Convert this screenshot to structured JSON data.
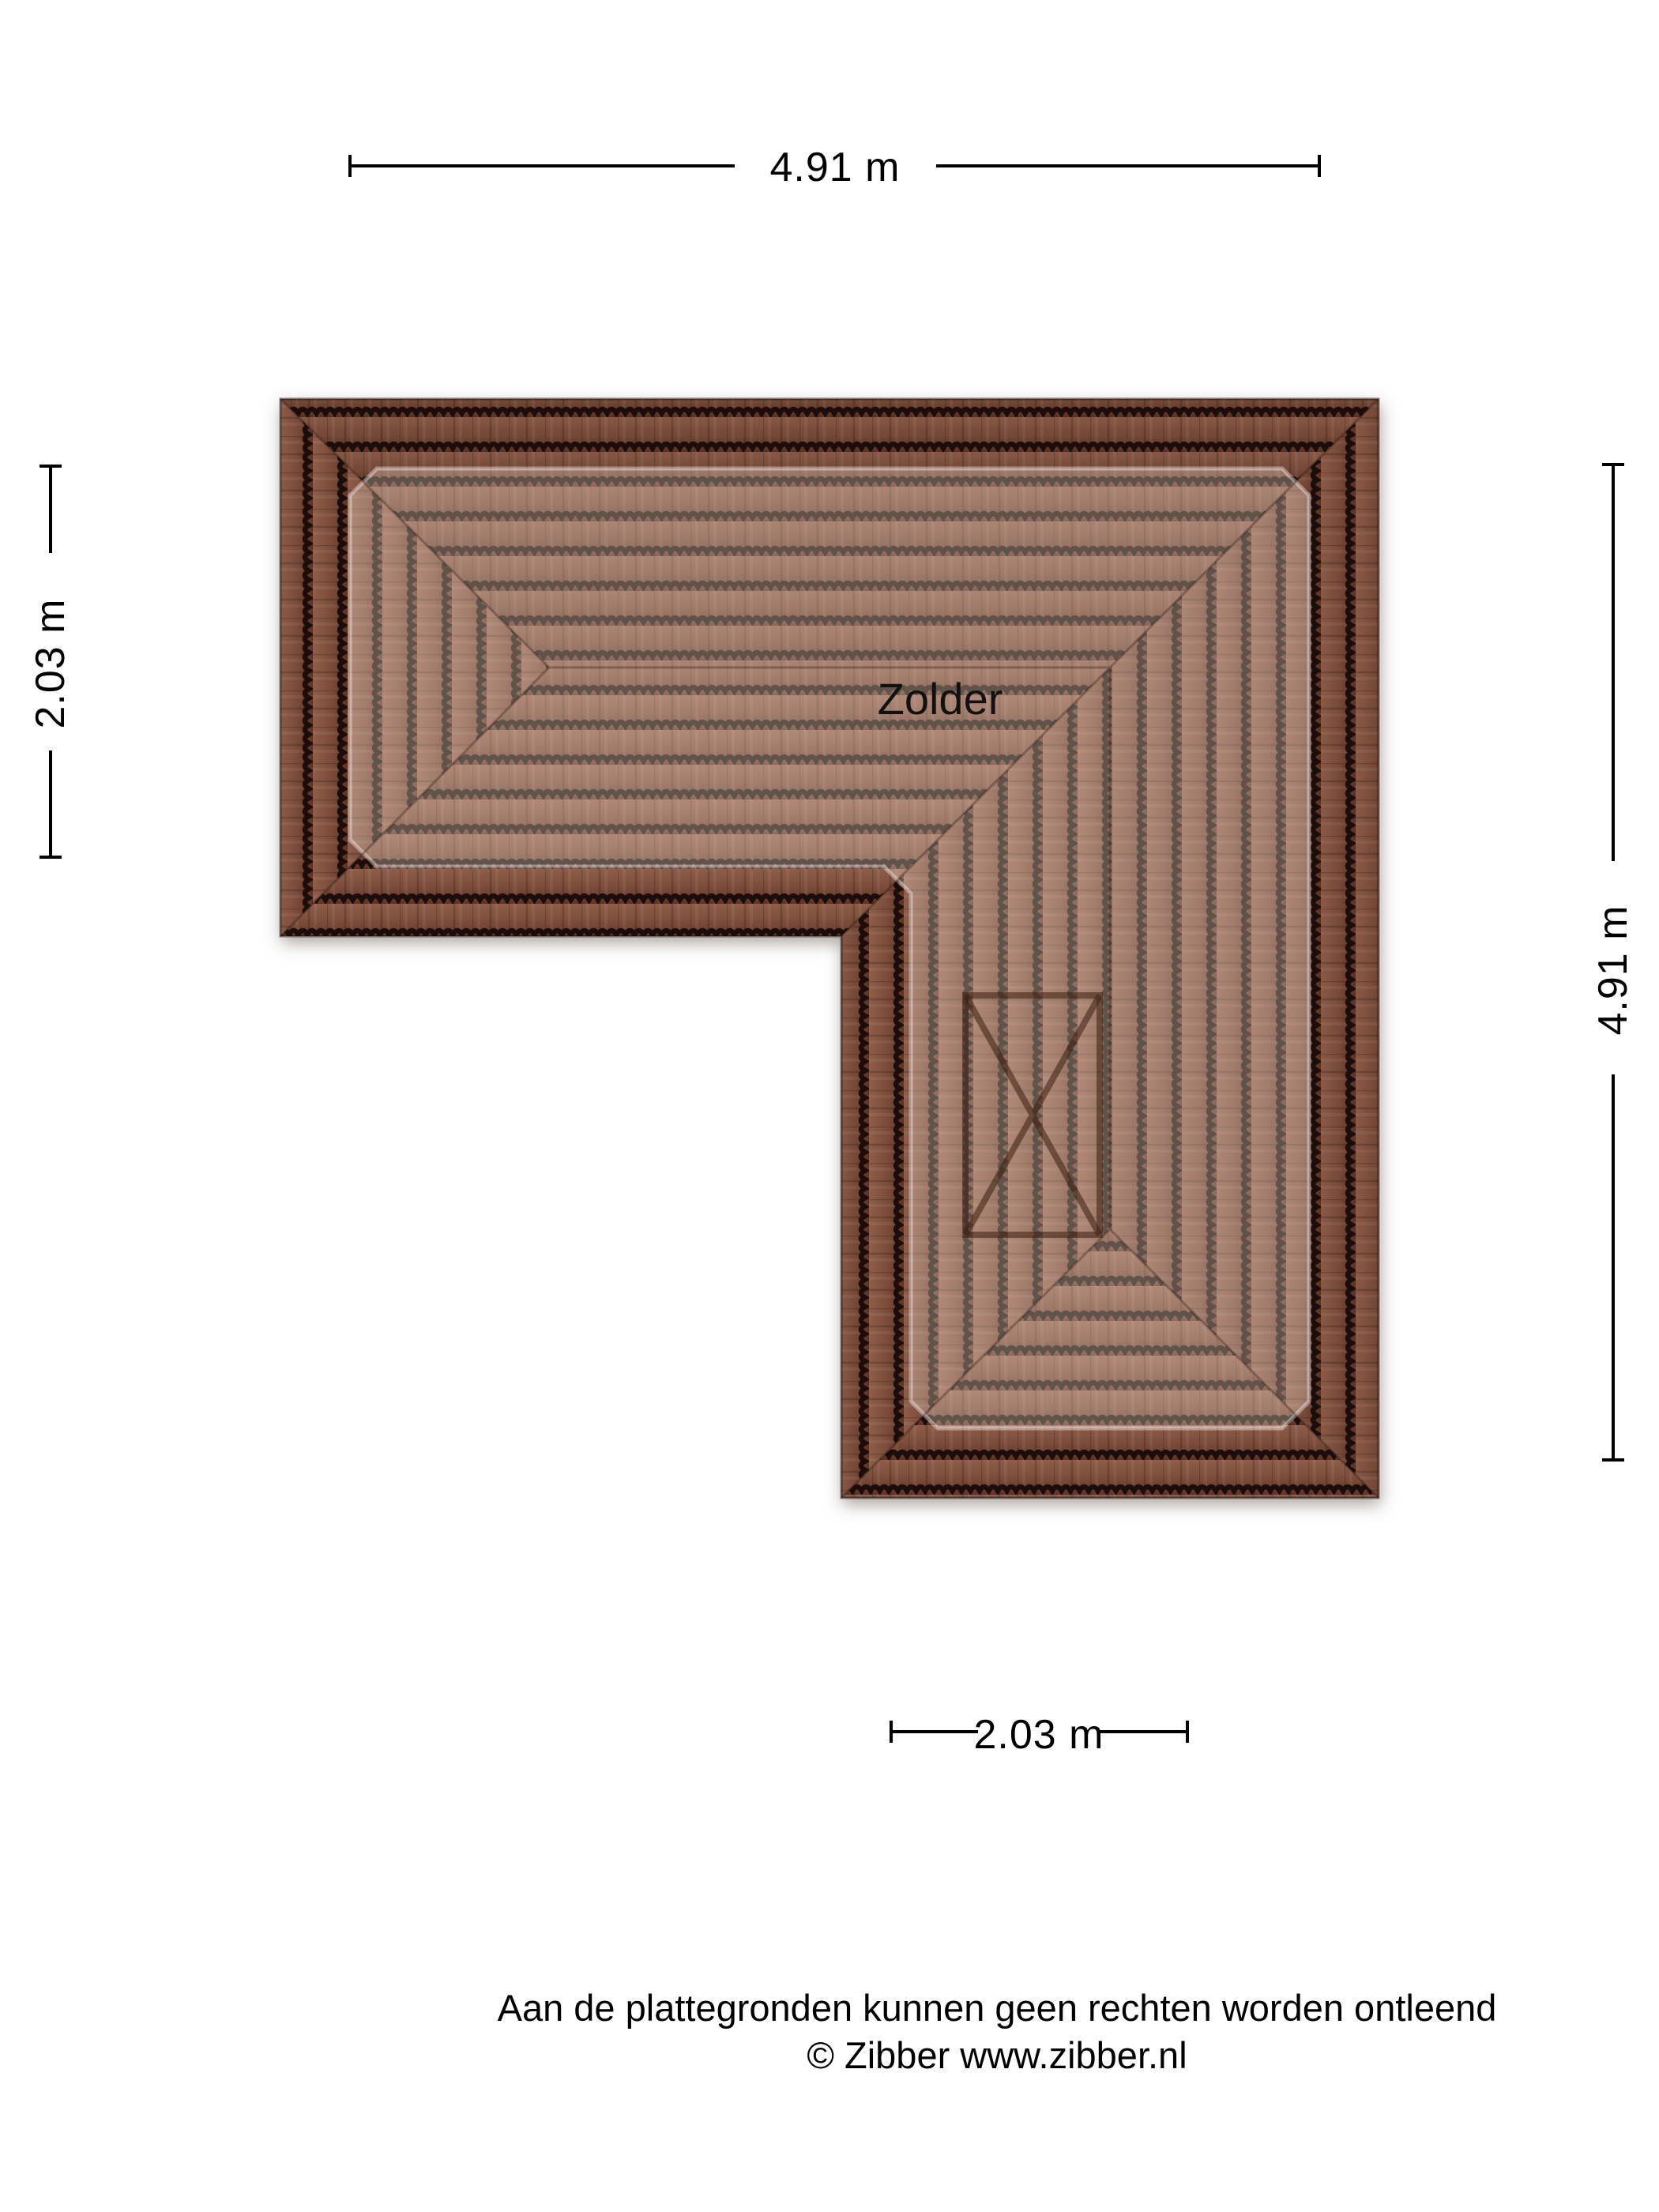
{
  "page": {
    "background_color": "#ffffff"
  },
  "floorplan": {
    "room_label": "Zolder",
    "dimensions": {
      "top": "4.91 m",
      "left": "2.03 m",
      "right": "4.91 m",
      "bottom": "2.03 m"
    },
    "colors": {
      "tile_dark_band": "#6b4130",
      "tile_highlight_area": "#ad7a64",
      "tile_joint_line": "#1e0f08",
      "dimension_line": "#000000",
      "text": "#111111"
    }
  },
  "footer": {
    "disclaimer": "Aan de plattegronden kunnen geen rechten worden ontleend",
    "copyright": "© Zibber www.zibber.nl"
  }
}
